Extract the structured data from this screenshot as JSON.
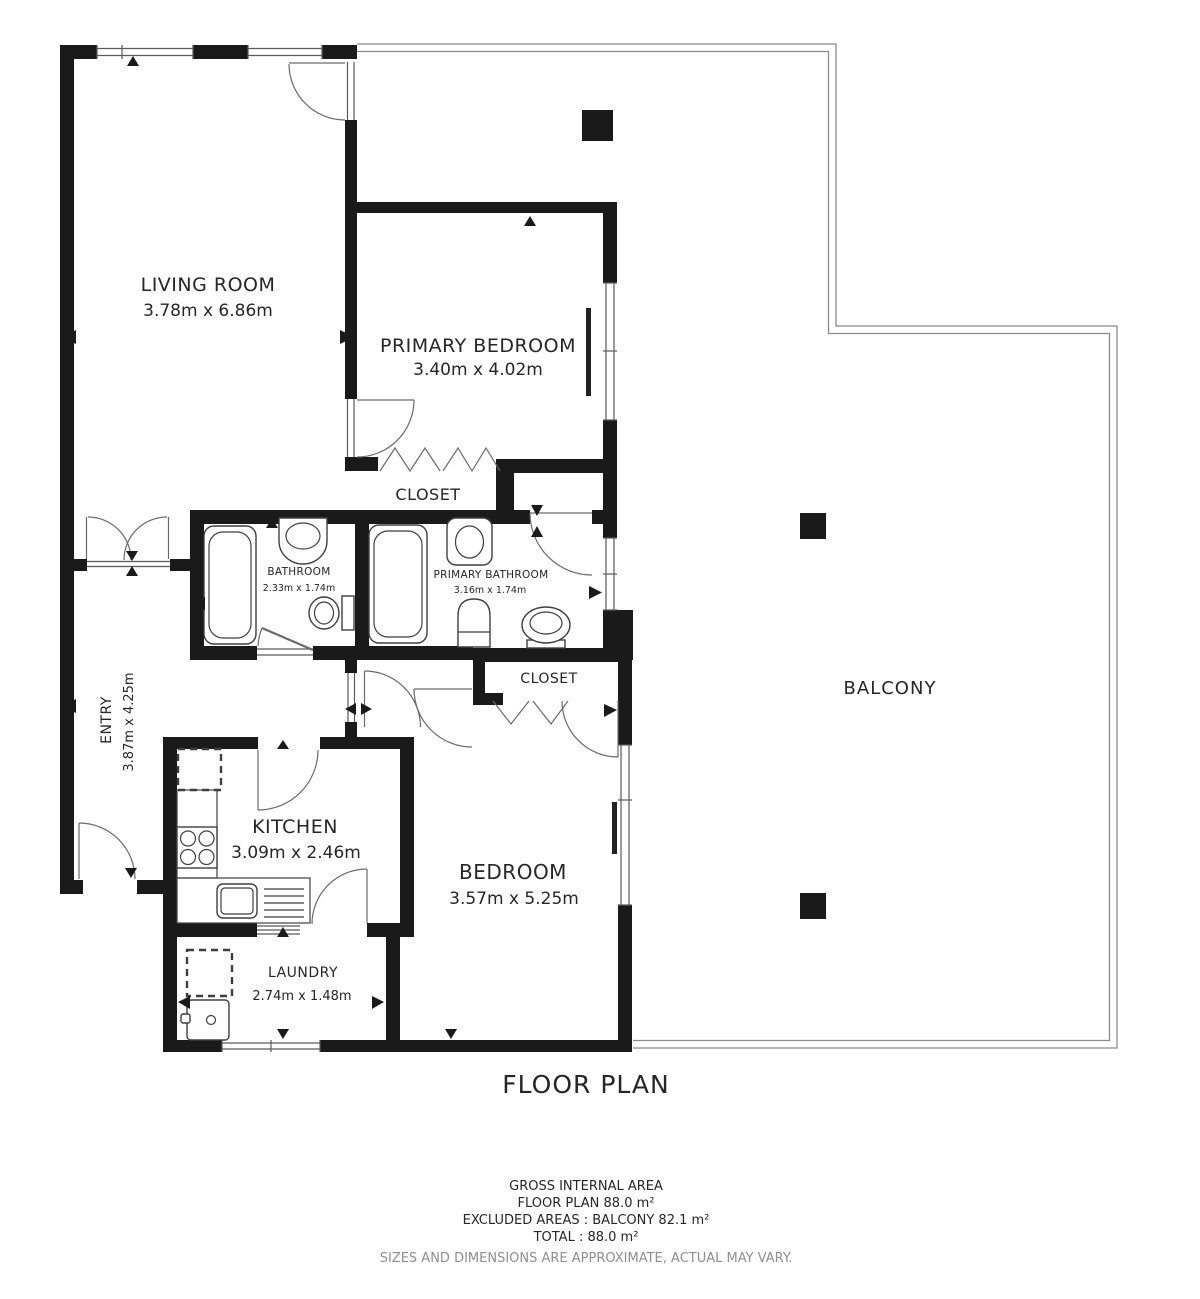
{
  "title": "FLOOR PLAN",
  "rooms": {
    "living_room": {
      "name": "LIVING ROOM",
      "dims": "3.78m x 6.86m"
    },
    "primary_bedroom": {
      "name": "PRIMARY BEDROOM",
      "dims": "3.40m x 4.02m"
    },
    "primary_closet": {
      "name": "CLOSET"
    },
    "bathroom": {
      "name": "BATHROOM",
      "dims": "2.33m x 1.74m"
    },
    "primary_bathroom": {
      "name": "PRIMARY BATHROOM",
      "dims": "3.16m x 1.74m"
    },
    "bedroom_closet": {
      "name": "CLOSET"
    },
    "entry": {
      "name": "ENTRY",
      "dims": "3.87m x 4.25m"
    },
    "kitchen": {
      "name": "KITCHEN",
      "dims": "3.09m x 2.46m"
    },
    "bedroom": {
      "name": "BEDROOM",
      "dims": "3.57m x 5.25m"
    },
    "laundry": {
      "name": "LAUNDRY",
      "dims": "2.74m x 1.48m"
    },
    "balcony": {
      "name": "BALCONY"
    }
  },
  "footer": {
    "gross_internal_area": "GROSS INTERNAL AREA",
    "floor_plan_area": "FLOOR PLAN 88.0 m²",
    "excluded_areas": "EXCLUDED AREAS :  BALCONY 82.1 m²",
    "total": "TOTAL :  88.0 m²",
    "disclaimer": "SIZES AND DIMENSIONS ARE APPROXIMATE, ACTUAL MAY VARY."
  },
  "colors": {
    "wall": "#1a1a1a",
    "line": "#5a5a5a",
    "muted": "#8f8f8f",
    "background": "#ffffff"
  }
}
